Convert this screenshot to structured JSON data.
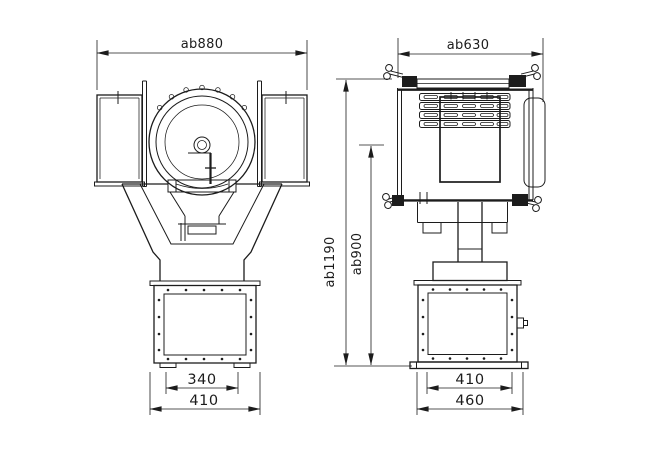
{
  "dimensions": {
    "front": {
      "overall_width": "ab880",
      "base_inner_width": "340",
      "base_outer_width": "410"
    },
    "side": {
      "overall_width": "ab630",
      "base_inner_width": "410",
      "base_outer_width": "460"
    },
    "heights": {
      "overall": "ab1190",
      "to_axis": "ab900"
    }
  },
  "colors": {
    "line": "#1c1c1c",
    "background": "#ffffff"
  }
}
